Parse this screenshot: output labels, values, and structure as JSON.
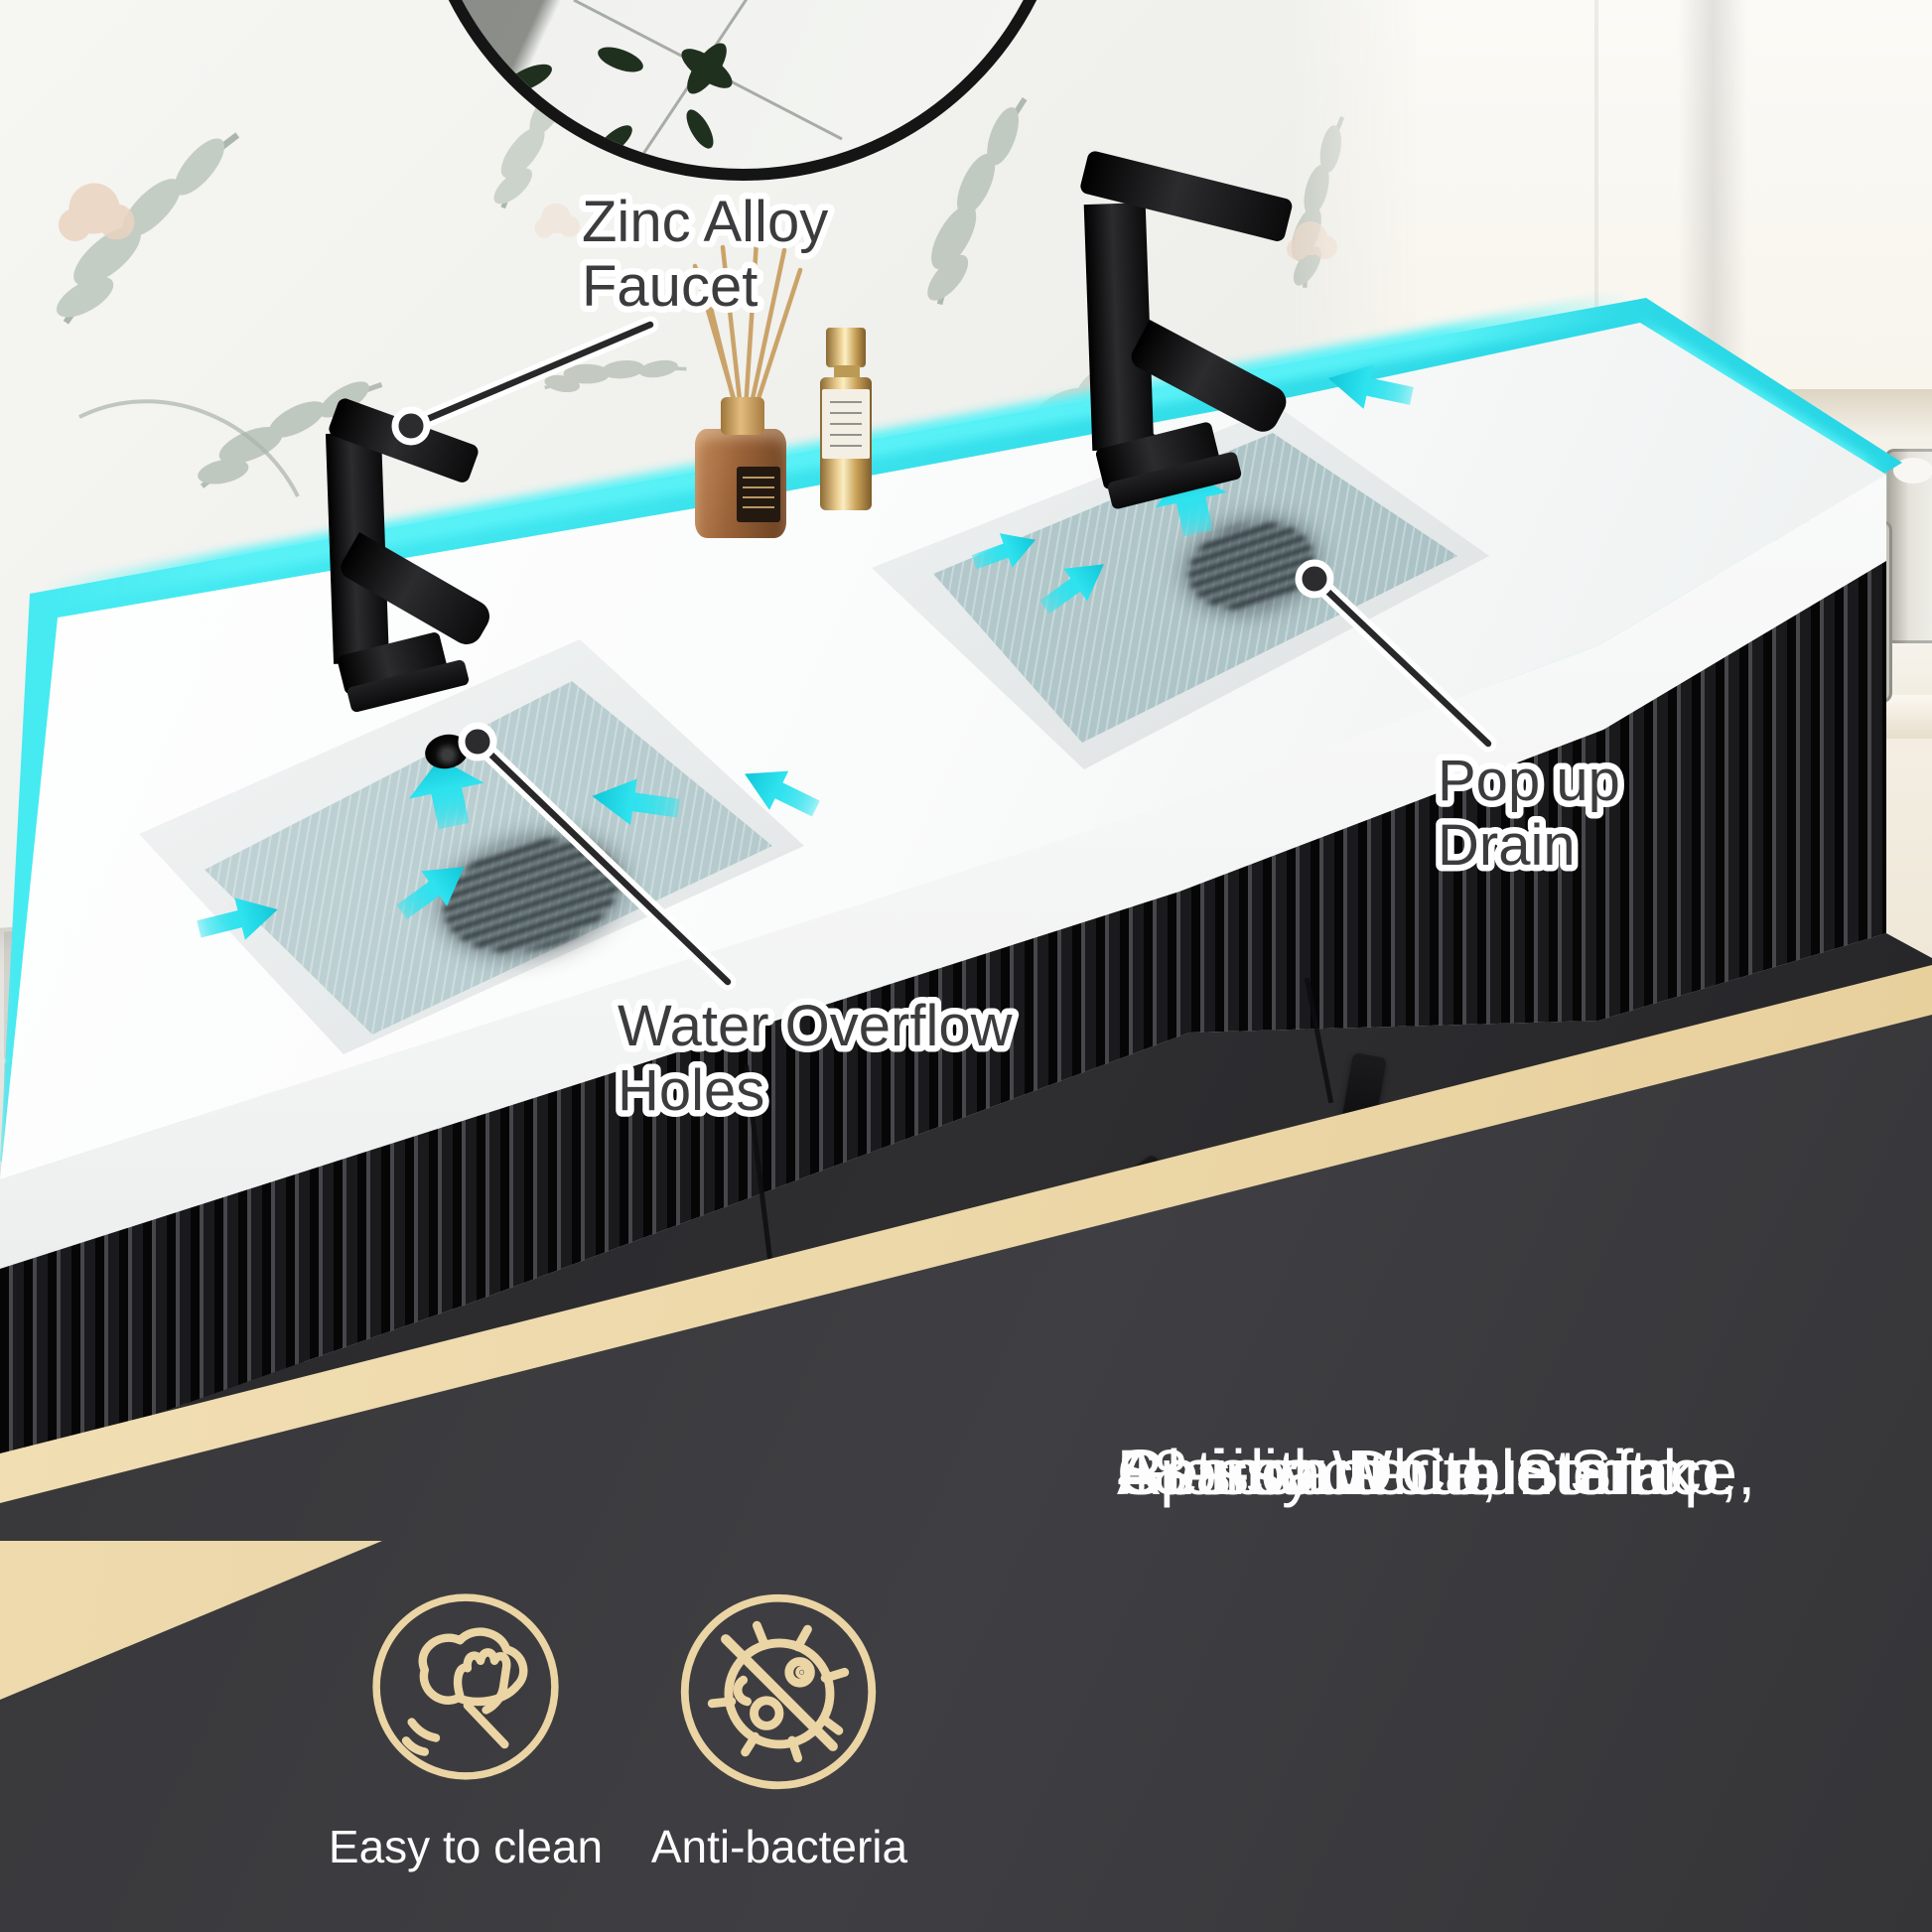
{
  "callouts": {
    "zinc_alloy": {
      "line1": "Zinc Alloy",
      "line2": "Faucet"
    },
    "water_overflow": {
      "line1": "Water Overflow",
      "line2": "Holes"
    },
    "pop_up_drain": {
      "line1": "Pop up",
      "line2": "Drain"
    }
  },
  "features": {
    "easy_to_clean": {
      "label": "Easy to clean",
      "icon": "wipe-hand-icon"
    },
    "anti_bacteria": {
      "label": "Anti-bacteria",
      "icon": "no-bacteria-icon"
    }
  },
  "headline": {
    "lines": [
      "48-inch Double Sink",
      "Spacious Countertop,",
      "Glossy White Surface,",
      "Anti-bacteria, Stain",
      "Resistant"
    ]
  },
  "colors": {
    "accent_cyan": "#2fdfe9",
    "accent_tan": "#ecd5a4",
    "panel_bg": "#39393c",
    "callout_text": "#3c3c3e",
    "headline_text": "#fdfdfd"
  }
}
